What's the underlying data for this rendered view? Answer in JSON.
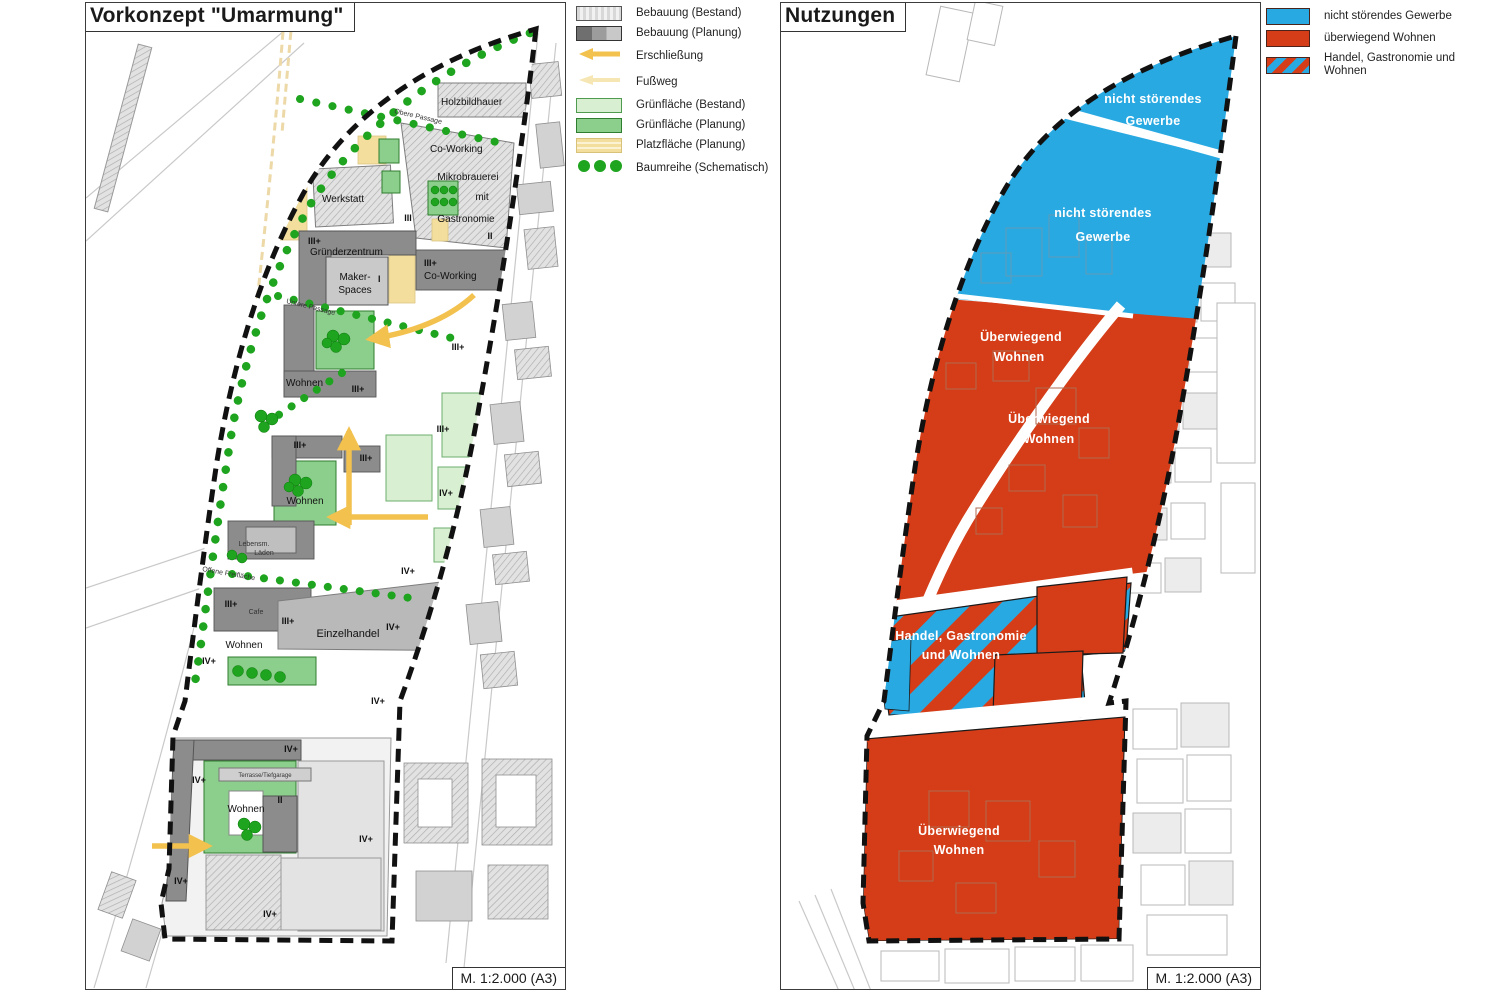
{
  "colors": {
    "gewerbe_blue": "#29A9E1",
    "wohnen_red": "#D43D17",
    "green_planning": "#8CCE8C",
    "green_existing": "#D9EFD2",
    "tree_green": "#1EA41E",
    "plaza_yellow": "#F3DE9E",
    "arrow_orange": "#F2C14E",
    "building_planned": "#8C8C8C",
    "building_existing_hatch": "#E0E0E0"
  },
  "left_panel": {
    "title": "Vorkonzept \"Umarmung\"",
    "scale_label": "M. 1:2.000 (A3)",
    "legend": {
      "items": [
        {
          "label": "Bebauung (Bestand)",
          "swatch": "bebauung-bestand"
        },
        {
          "label": "Bebauung (Planung)",
          "swatch": "bebauung-planung"
        },
        {
          "label": "Erschließung",
          "swatch": "erschliessung-arrow"
        },
        {
          "label": "Fußweg",
          "swatch": "fussweg-arrow"
        },
        {
          "label": "Grünfläche (Bestand)",
          "swatch": "gruenflaeche-bestand"
        },
        {
          "label": "Grünfläche (Planung)",
          "swatch": "gruenflaeche-planung"
        },
        {
          "label": "Platzfläche (Planung)",
          "swatch": "platzflaeche-planung"
        },
        {
          "label": "Baumreihe (Schematisch)",
          "swatch": "baumreihe-dots"
        }
      ]
    },
    "map_labels": {
      "holzbildhauer": "Holzbildhauer",
      "co_working_1": "Co-Working",
      "werkstatt": "Werkstatt",
      "mikrobrauerei_1": "Mikrobrauerei",
      "mikrobrauerei_2": "mit",
      "mikrobrauerei_3": "Gastronomie",
      "floor_iii_top": "III",
      "floor_ii_top": "II",
      "gruenderzentrum_floor": "III+",
      "gruenderzentrum": "Gründerzentrum",
      "maker_1": "Maker-",
      "maker_2": "Spaces",
      "maker_floor": "I",
      "co_working_2_floor": "III+",
      "co_working_2": "Co-Working",
      "obere_passage": "Obere Passage",
      "untere_passage": "Untere Passage",
      "offene_freiflaeche": "Offene Freifläche",
      "wohnen_1": "Wohnen",
      "wohnen_2": "Wohnen",
      "wohnen_3": "Wohnen",
      "wohnen_4": "Wohnen",
      "laeden_1": "Lebensm.",
      "laeden_2": "Läden",
      "cafe": "Cafe",
      "einzelhandel": "Einzelhandel",
      "terrasse": "Terrasse/Tiefgarage",
      "floor_ii_bottom": "II"
    },
    "floor_markers": [
      "III+",
      "III+",
      "III+",
      "III+",
      "III+",
      "IV+",
      "IV+",
      "III+",
      "III+",
      "IV+",
      "IV+",
      "IV+",
      "IV+",
      "IV+",
      "IV+",
      "IV+",
      "IV+"
    ]
  },
  "right_panel": {
    "title": "Nutzungen",
    "scale_label": "M. 1:2.000 (A3)",
    "legend": {
      "items": [
        {
          "label": "nicht störendes Gewerbe",
          "swatch": "gewerbe"
        },
        {
          "label": "überwiegend Wohnen",
          "swatch": "wohnen"
        },
        {
          "label": "Handel, Gastronomie und Wohnen",
          "swatch": "handel-gastronomie-wohnen"
        }
      ]
    },
    "zone_labels": {
      "gewerbe_top_1": "nicht störendes",
      "gewerbe_top_2": "Gewerbe",
      "gewerbe_mid_1": "nicht störendes",
      "gewerbe_mid_2": "Gewerbe",
      "wohnen_upper_1": "Überwiegend",
      "wohnen_upper_2": "Wohnen",
      "wohnen_mid_1": "Überwiegend",
      "wohnen_mid_2": "Wohnen",
      "handel_1": "Handel, Gastronomie",
      "handel_2": "und Wohnen",
      "wohnen_bottom_1": "Überwiegend",
      "wohnen_bottom_2": "Wohnen"
    }
  }
}
